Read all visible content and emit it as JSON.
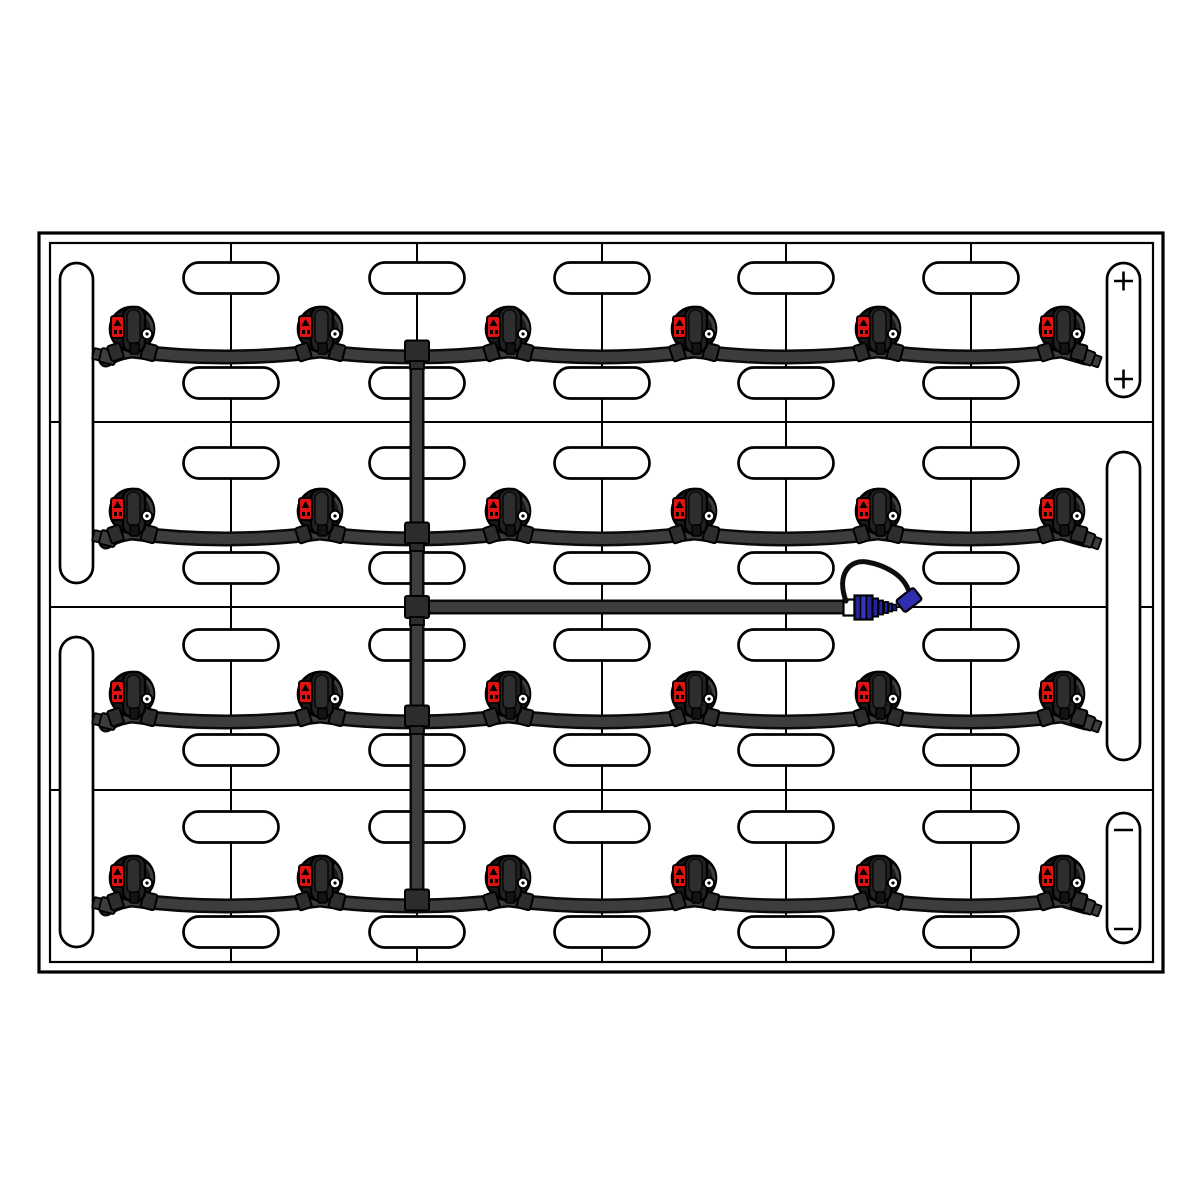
{
  "diagram": {
    "kind": "battery-watering-system-top-view",
    "canvas": {
      "w": 1200,
      "h": 1200,
      "bg": "#ffffff"
    },
    "colors": {
      "line": "#000000",
      "case_fill": "#ffffff",
      "tube_core": "#3d3d3d",
      "tube_outline": "#0a0a0a",
      "fitting": "#2c2c2c",
      "cap_body": "#191919",
      "cap_lever": "#222222",
      "cap_lever_inner": "#2e2e2e",
      "cap_notch": "#131313",
      "cap_wing": "#2d2d2d",
      "cap_highlight": "#3f3f3f",
      "indicator_red": "#e01313",
      "eyelet_fill": "#ffffff",
      "coupler_blue": "#23239e",
      "coupler_stripe": "#3535b5",
      "dust_cap_blue": "#2e2eae",
      "strap_black": "#0d0d0d",
      "band_white": "#ffffff"
    },
    "case": {
      "outer": [
        39,
        233,
        1124,
        739
      ],
      "inner": [
        50,
        243,
        1103,
        719
      ],
      "outer_stroke": 3.2,
      "inner_stroke": 2.2
    },
    "grid": {
      "vline_xs": [
        231,
        417,
        602,
        786,
        971
      ],
      "vline_y1": 243,
      "vline_y2": 962,
      "hline_ys": [
        422,
        607,
        790
      ],
      "hline_x1": 50,
      "hline_x2": 1153,
      "stroke": 2
    },
    "vent_pills": {
      "xs": [
        231,
        417,
        602,
        786,
        971
      ],
      "ys": [
        278,
        383,
        463,
        568,
        645,
        750,
        827,
        932
      ],
      "w": 95,
      "h": 31,
      "stroke": 2.7
    },
    "handles": [
      {
        "rect": [
          60,
          263,
          33,
          320
        ]
      },
      {
        "rect": [
          60,
          637,
          33,
          310
        ]
      },
      {
        "rect": [
          1107,
          452,
          33,
          308
        ]
      }
    ],
    "terminals": [
      {
        "rect": [
          1107,
          263,
          33,
          134
        ],
        "symbol": "+",
        "symbol_x": 1123.5,
        "symbol_ys": [
          281,
          379
        ]
      },
      {
        "rect": [
          1107,
          813,
          33,
          130
        ],
        "symbol": "-",
        "symbol_x": 1123.5,
        "symbol_ys": [
          830,
          929
        ]
      }
    ],
    "terminal_symbol": {
      "arm": 9.5,
      "stroke": 2.6
    },
    "watering_rows": {
      "cap_xs": [
        132,
        320,
        508,
        694,
        878,
        1062
      ],
      "cap_cys": [
        329,
        511,
        694,
        878
      ],
      "tube_offset": 22,
      "sag": 12,
      "cap_radius": 22
    },
    "manifold": {
      "x": 417,
      "y1": 349,
      "y2": 902
    },
    "feed": {
      "y": 607,
      "x1": 419,
      "x2": 845
    },
    "tube": {
      "outline_w": 15,
      "core_w": 10
    },
    "coupler": {
      "band": [
        843.5,
        599.5,
        11,
        16
      ],
      "body": [
        854.5,
        595.5,
        18,
        24
      ],
      "collar": [
        872.5,
        598.5,
        5.5,
        18
      ],
      "ribs": [
        [
          878.5,
          600.5,
          4.5,
          14
        ],
        [
          884,
          602,
          4,
          11
        ],
        [
          888.5,
          603.5,
          3.5,
          8
        ]
      ],
      "tip": [
        892.5,
        604.5,
        4,
        6
      ],
      "dust_cap": {
        "rect": [
          898,
          592.5,
          22,
          15
        ],
        "rotate": -38,
        "cx": 909,
        "cy": 600
      },
      "strap_path": "M 846 601 C 836 574, 850 559, 867 562 C 884 565, 902 574, 908 589"
    }
  }
}
